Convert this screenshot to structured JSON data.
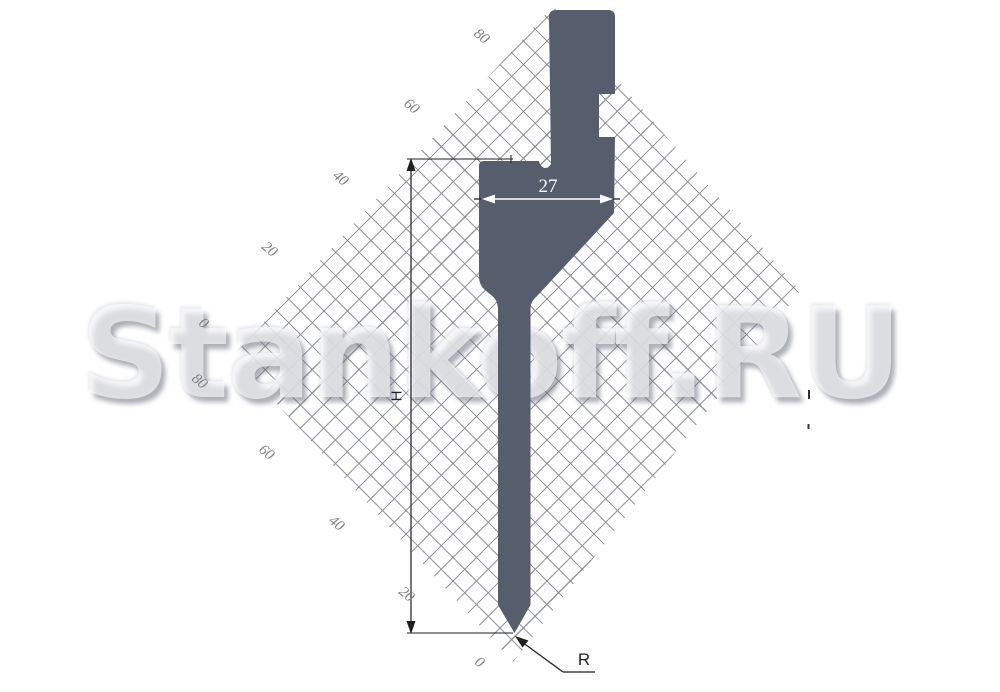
{
  "watermark": {
    "text": "Stankoff.RU"
  },
  "dimensions": {
    "width_value": "27",
    "height_label": "H",
    "radius_label": "R"
  },
  "grid": {
    "upper_labels": [
      "80",
      "60",
      "40",
      "20",
      "0"
    ],
    "lower_labels": [
      "80",
      "60",
      "40",
      "20",
      "0"
    ]
  },
  "colors": {
    "tool_fill": "#565E6E",
    "grid_line": "#82858E",
    "dimension_line": "#1F1F1F",
    "dimension_text_on_tool": "#FFFFFF",
    "grid_label_text": "#7E7E84"
  }
}
